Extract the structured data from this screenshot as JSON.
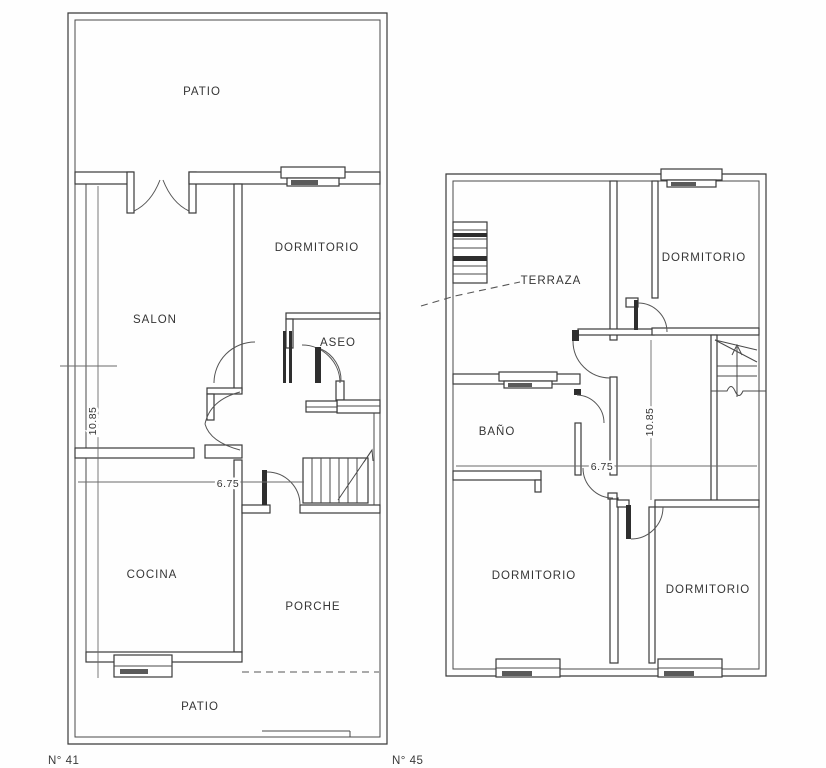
{
  "page": {
    "background": "#fefefe",
    "ink_color": "#3a3a3a",
    "description": "Two architectural floor plans, ground floor and upper floor"
  },
  "plans": [
    {
      "number_label": "N° 41",
      "rooms": [
        {
          "key": "patio-top",
          "label": "PATIO"
        },
        {
          "key": "dormitorio",
          "label": "DORMITORIO"
        },
        {
          "key": "salon",
          "label": "SALON"
        },
        {
          "key": "aseo",
          "label": "ASEO"
        },
        {
          "key": "cocina",
          "label": "COCINA"
        },
        {
          "key": "porche",
          "label": "PORCHE"
        },
        {
          "key": "patio-bottom",
          "label": "PATIO"
        }
      ],
      "dimensions": [
        {
          "key": "vertical",
          "value": "10.85"
        },
        {
          "key": "horizontal",
          "value": "6.75"
        }
      ]
    },
    {
      "number_label": "N° 45",
      "rooms": [
        {
          "key": "terraza",
          "label": "TERRAZA"
        },
        {
          "key": "dormitorio-top",
          "label": "DORMITORIO"
        },
        {
          "key": "bano",
          "label": "BAÑO"
        },
        {
          "key": "dormitorio-bottom-left",
          "label": "DORMITORIO"
        },
        {
          "key": "dormitorio-bottom-right",
          "label": "DORMITORIO"
        }
      ],
      "dimensions": [
        {
          "key": "vertical",
          "value": "10.85"
        },
        {
          "key": "horizontal",
          "value": "6.75"
        }
      ]
    }
  ]
}
